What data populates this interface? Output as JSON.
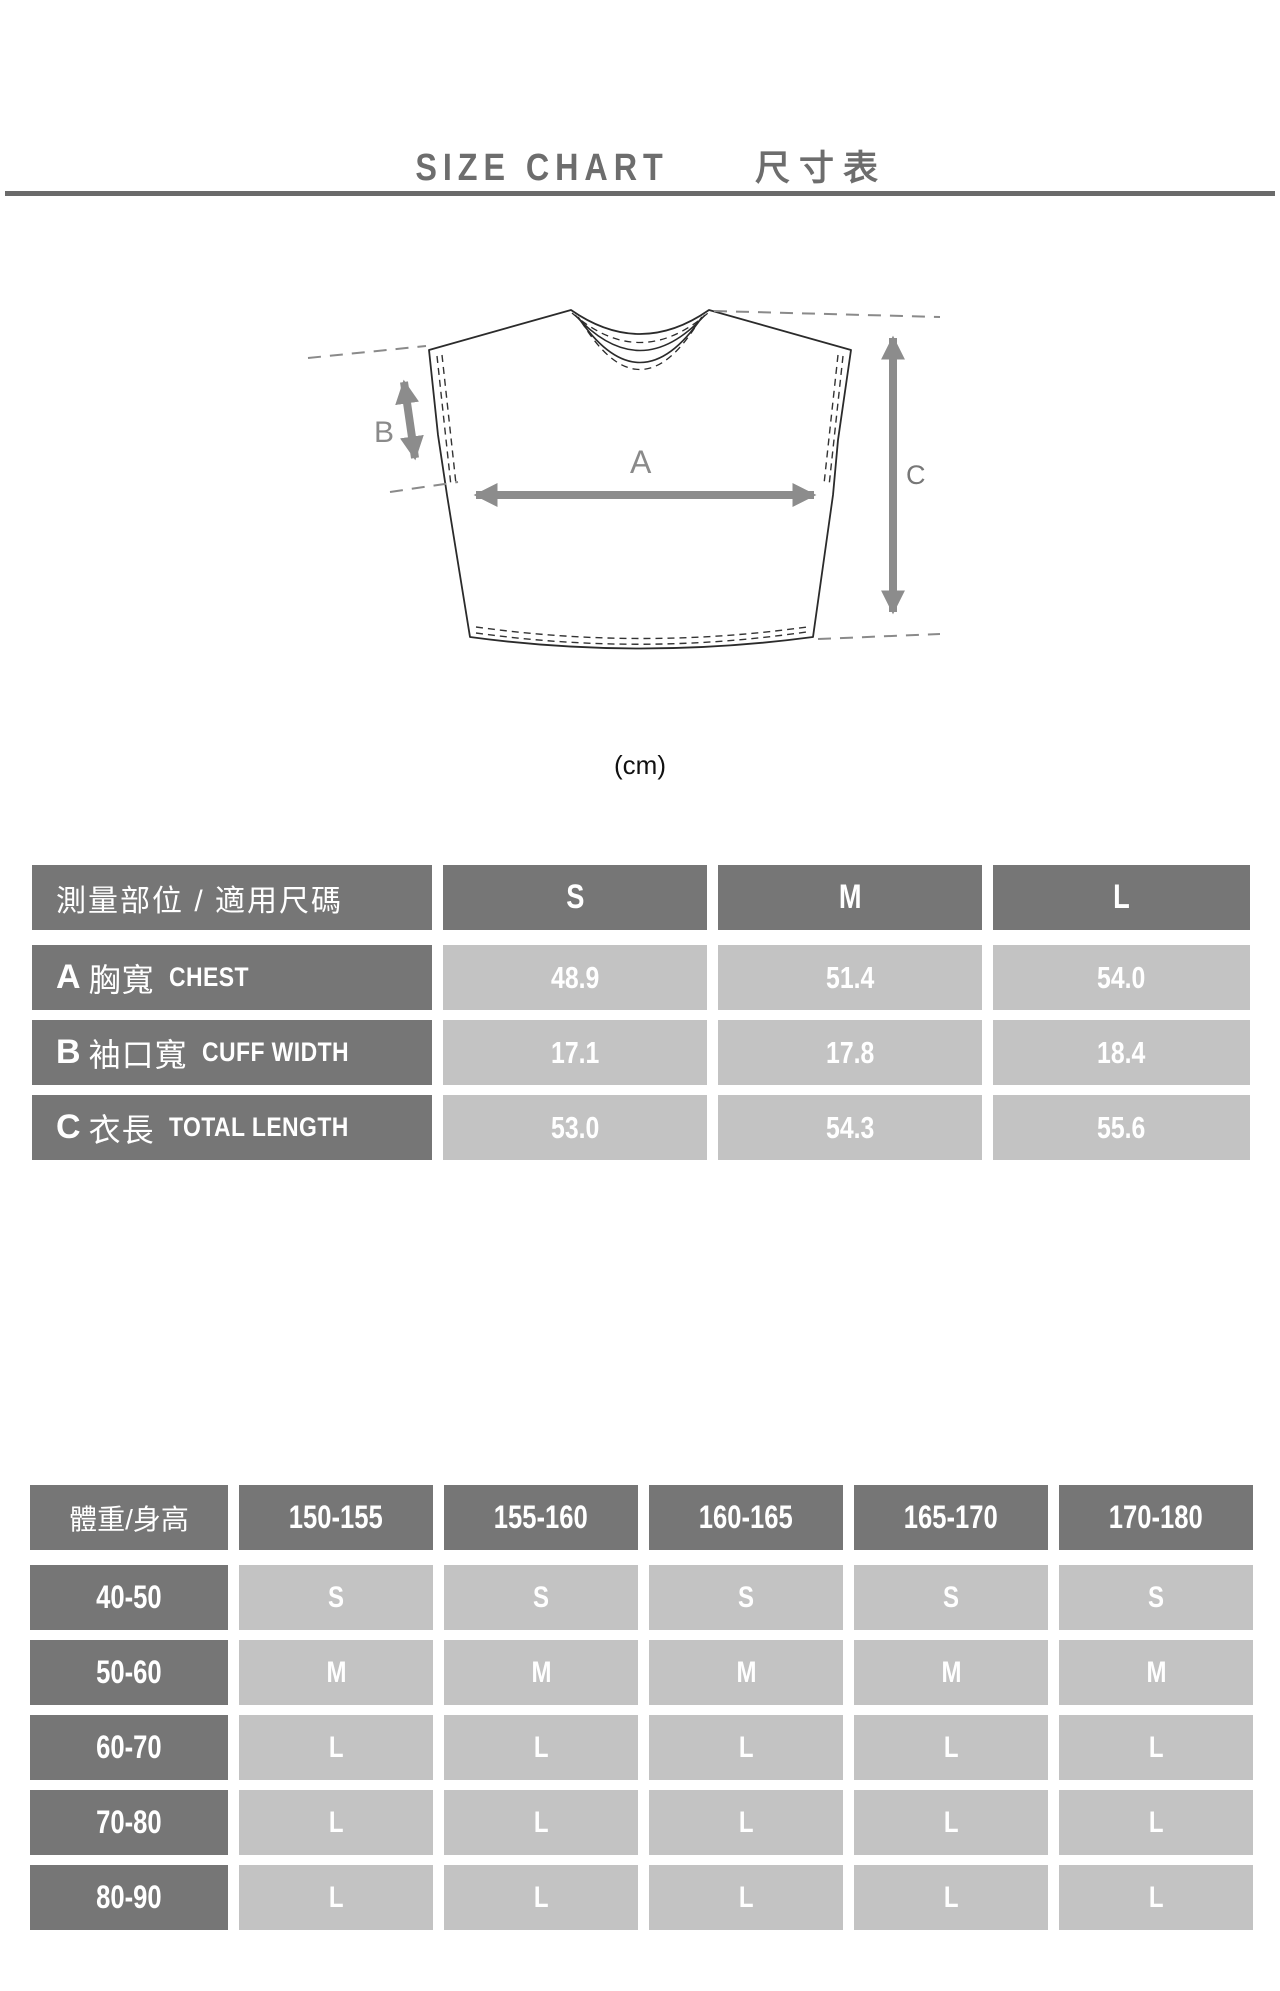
{
  "page": {
    "title_en": "SIZE CHART",
    "title_zh": "尺寸表",
    "unit_label": "(cm)"
  },
  "diagram": {
    "labels": {
      "a": "A",
      "b": "B",
      "c": "C"
    }
  },
  "measure_table": {
    "header": {
      "label": "測量部位 / 適用尺碼",
      "sizes": [
        "S",
        "M",
        "L"
      ]
    },
    "rows": [
      {
        "letter": "A",
        "zh": "胸寬",
        "en": "CHEST",
        "values": [
          "48.9",
          "51.4",
          "54.0"
        ]
      },
      {
        "letter": "B",
        "zh": "袖口寬",
        "en": "CUFF WIDTH",
        "values": [
          "17.1",
          "17.8",
          "18.4"
        ]
      },
      {
        "letter": "C",
        "zh": "衣長",
        "en": "TOTAL LENGTH",
        "values": [
          "53.0",
          "54.3",
          "55.6"
        ]
      }
    ]
  },
  "fit_table": {
    "corner_label": "體重/身高",
    "height_ranges": [
      "150-155",
      "155-160",
      "160-165",
      "165-170",
      "170-180"
    ],
    "rows": [
      {
        "weight": "40-50",
        "sizes": [
          "S",
          "S",
          "S",
          "S",
          "S"
        ]
      },
      {
        "weight": "50-60",
        "sizes": [
          "M",
          "M",
          "M",
          "M",
          "M"
        ]
      },
      {
        "weight": "60-70",
        "sizes": [
          "L",
          "L",
          "L",
          "L",
          "L"
        ]
      },
      {
        "weight": "70-80",
        "sizes": [
          "L",
          "L",
          "L",
          "L",
          "L"
        ]
      },
      {
        "weight": "80-90",
        "sizes": [
          "L",
          "L",
          "L",
          "L",
          "L"
        ]
      }
    ]
  },
  "colors": {
    "dark_cell": "#767676",
    "light_cell": "#c3c3c3",
    "title_gray": "#6d6d6d",
    "rule_gray": "#6a6a6a",
    "arrow_gray": "#8c8c8c",
    "outline": "#2b2b2b"
  }
}
